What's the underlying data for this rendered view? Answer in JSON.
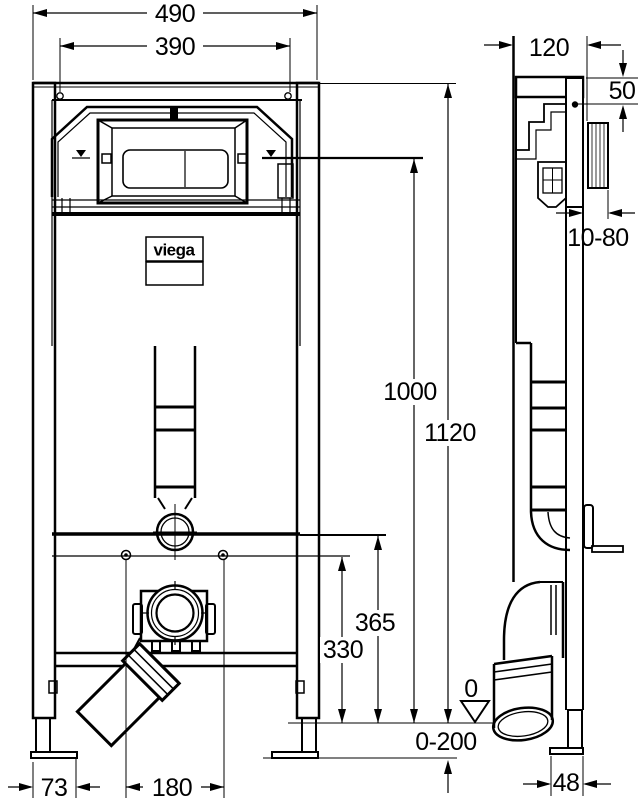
{
  "drawing": {
    "brand_logo": "viega",
    "dimensions": {
      "overall_width": "490",
      "fixing_hole_spacing": "390",
      "frame_depth": "120",
      "plate_top_offset": "50",
      "finished_wall_range": "10-80",
      "actuation_height": "1000",
      "frame_height": "1120",
      "supply_height": "365",
      "bracket_height": "330",
      "floor_level": "0",
      "floor_adjust_range": "0-200",
      "foot_plate_width": "73",
      "drain_offset": "180",
      "foot_depth": "48"
    }
  }
}
